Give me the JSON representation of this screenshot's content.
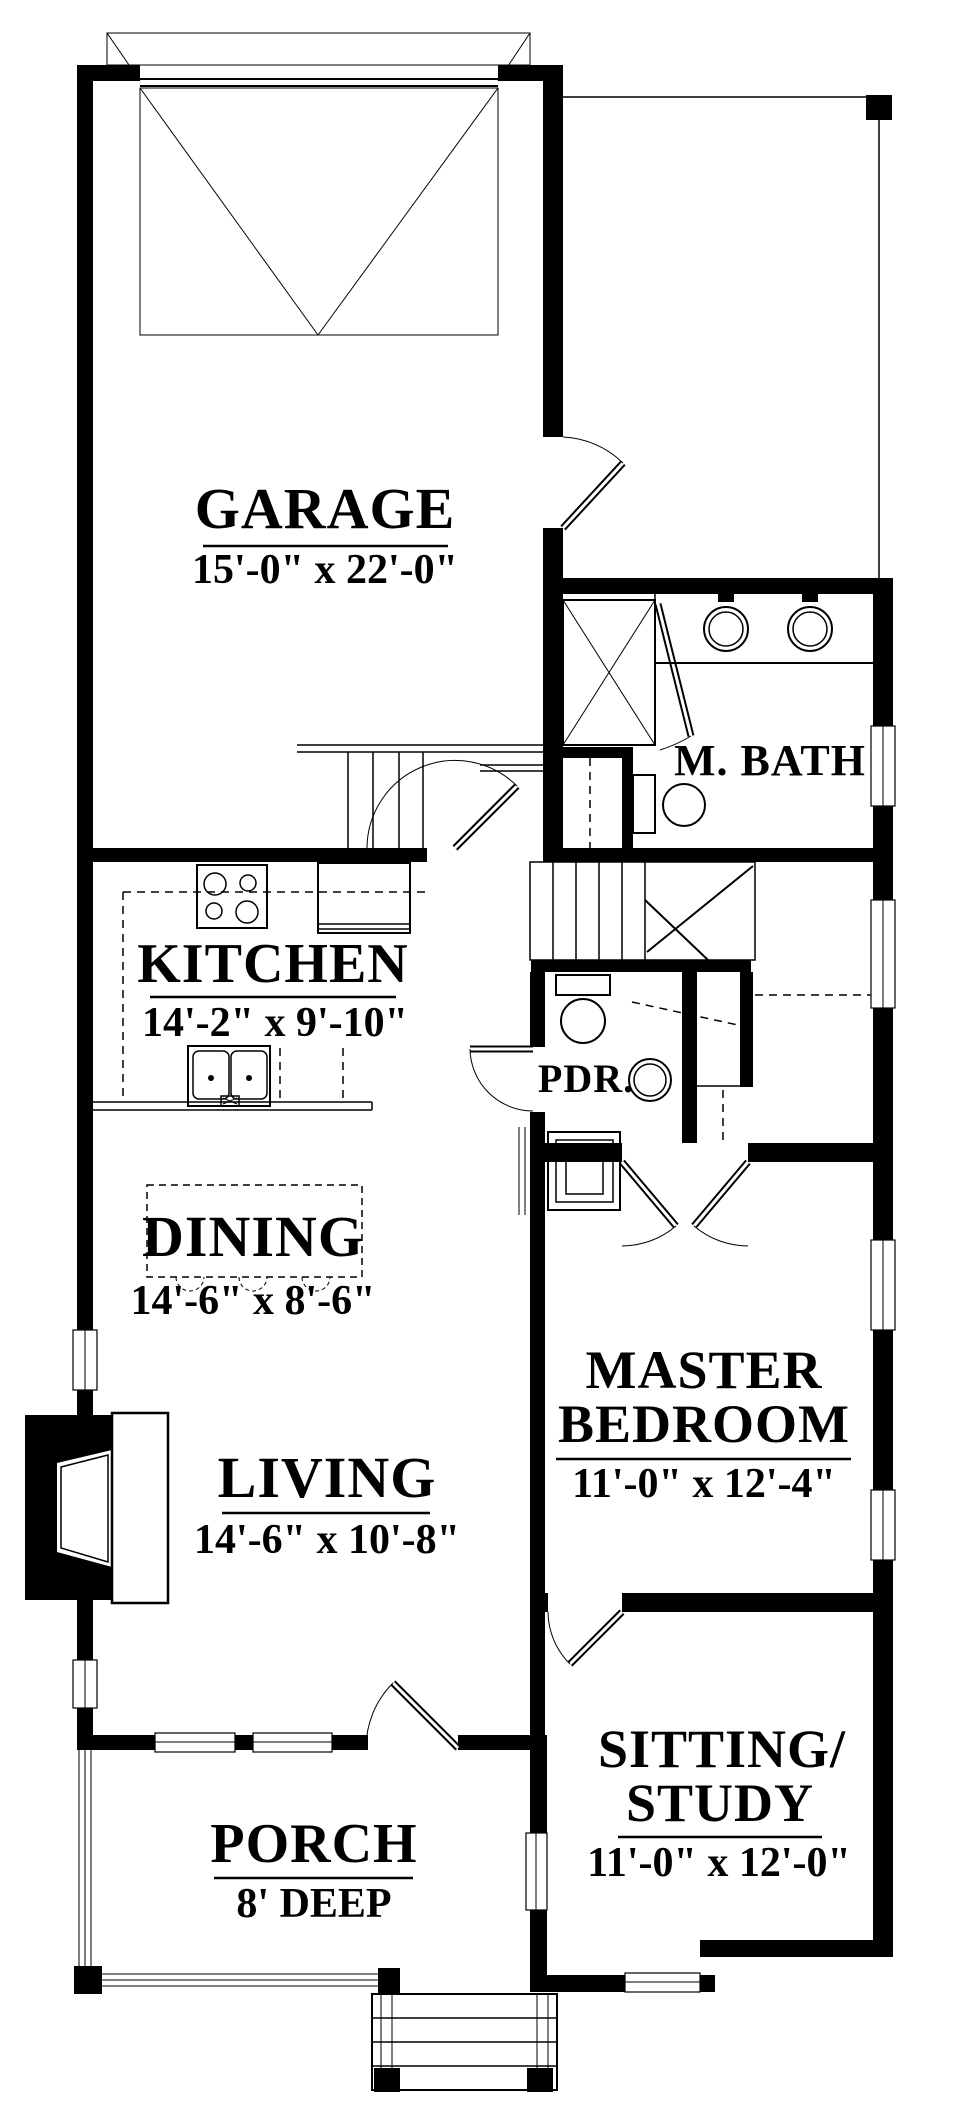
{
  "plan": {
    "colors": {
      "ink": "#000000",
      "paper": "#ffffff"
    },
    "rooms": {
      "garage": {
        "name": "GARAGE",
        "dims": "15'-0\" x 22'-0\""
      },
      "kitchen": {
        "name": "KITCHEN",
        "dims": "14'-2\" x 9'-10\""
      },
      "dining": {
        "name": "DINING",
        "dims": "14'-6\" x 8'-6\""
      },
      "living": {
        "name": "LIVING",
        "dims": "14'-6\" x 10'-8\""
      },
      "master_bedroom": {
        "name_line1": "MASTER",
        "name_line2": "BEDROOM",
        "dims": "11'-0\" x 12'-4\""
      },
      "master_bath": {
        "name": "M. BATH"
      },
      "powder_room": {
        "name": "PDR."
      },
      "sitting_study": {
        "name_line1": "SITTING/",
        "name_line2": "STUDY",
        "dims": "11'-0\" x 12'-0\""
      },
      "porch": {
        "name": "PORCH",
        "dims": "8' DEEP"
      }
    }
  }
}
